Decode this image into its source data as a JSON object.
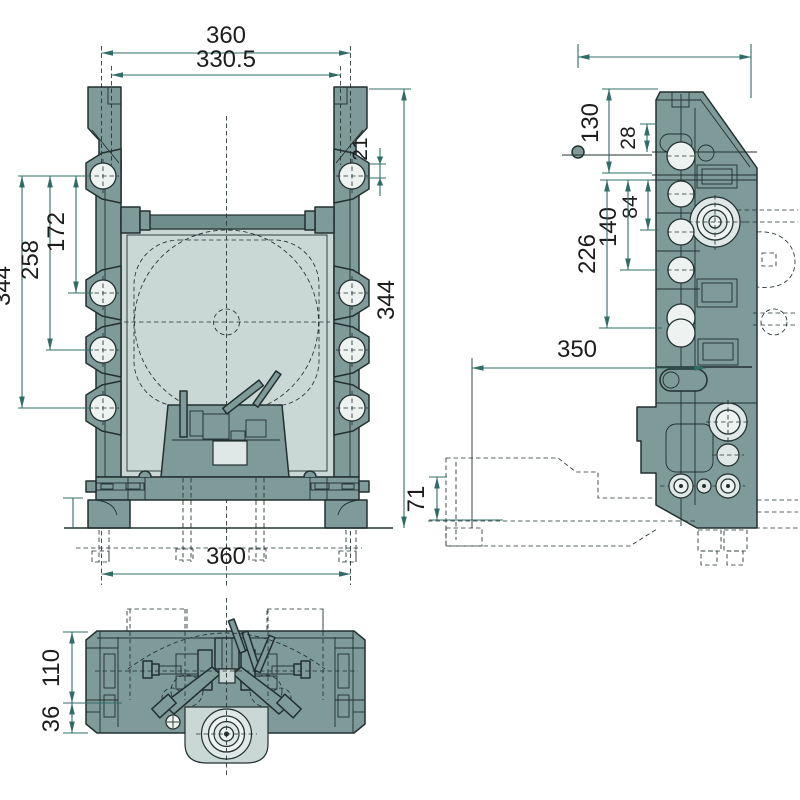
{
  "colors": {
    "bg": "#ffffff",
    "body": "#7e9b99",
    "body_dark": "#6e8d8b",
    "cavity": "#c9d7d5",
    "ring": "#dfe8e6",
    "hole": "#eef3f2",
    "outline": "#223030",
    "dim": "#306d66",
    "text": "#1d1d1d"
  },
  "front_view": {
    "dim_width_top": "360",
    "dim_width_inner": "330.5",
    "dim_lobe_offset": "21",
    "dim_hole_span_1": "172",
    "dim_hole_span_2": "258",
    "dim_hole_span_3": "344",
    "dim_overall_height": "344",
    "dim_width_bottom": "360"
  },
  "side_view": {
    "dim_top_to_hole": "130",
    "dim_hole_offset": "28",
    "dim_span_a": "84",
    "dim_span_b": "140",
    "dim_span_c": "226",
    "dim_reach": "350",
    "dim_clamp_height": "71"
  },
  "bottom_view": {
    "dim_depth": "110",
    "dim_boss_depth": "36"
  }
}
